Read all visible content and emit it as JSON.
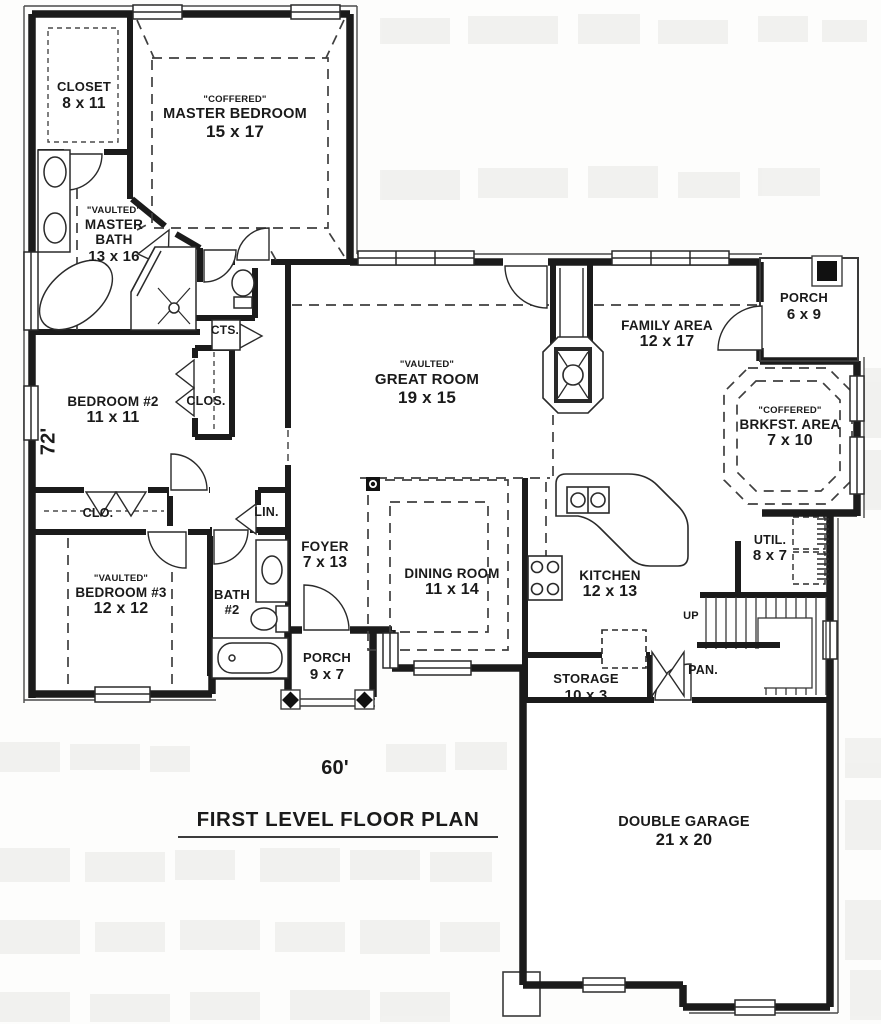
{
  "plan": {
    "title": "FIRST LEVEL FLOOR PLAN",
    "overall_width": "60'",
    "overall_depth": "72'",
    "rooms": {
      "closet": {
        "name": "CLOSET",
        "dims": "8 x 11"
      },
      "master_bedroom": {
        "ceiling": "\"COFFERED\"",
        "name": "MASTER BEDROOM",
        "dims": "15 x 17"
      },
      "master_bath": {
        "ceiling": "\"VAULTED\"",
        "name": "MASTER BATH",
        "dims": "13 x 16"
      },
      "cts": {
        "name": "CTS."
      },
      "bedroom2": {
        "name": "BEDROOM #2",
        "dims": "11 x 11"
      },
      "clos": {
        "name": "CLOS."
      },
      "great_room": {
        "ceiling": "\"VAULTED\"",
        "name": "GREAT ROOM",
        "dims": "19 x 15"
      },
      "family_area": {
        "name": "FAMILY AREA",
        "dims": "12 x 17"
      },
      "porch_rear": {
        "name": "PORCH",
        "dims": "6 x 9"
      },
      "brkfst": {
        "ceiling": "\"COFFERED\"",
        "name": "BRKFST. AREA",
        "dims": "7 x 10"
      },
      "clo": {
        "name": "CLO."
      },
      "lin": {
        "name": "LIN."
      },
      "foyer": {
        "name": "FOYER",
        "dims": "7 x 13"
      },
      "bedroom3": {
        "ceiling": "\"VAULTED\"",
        "name": "BEDROOM #3",
        "dims": "12 x 12"
      },
      "bath2": {
        "name": "BATH",
        "num": "#2"
      },
      "porch_front": {
        "name": "PORCH",
        "dims": "9 x 7"
      },
      "dining": {
        "name": "DINING ROOM",
        "dims": "11 x 14"
      },
      "kitchen": {
        "name": "KITCHEN",
        "dims": "12 x 13"
      },
      "storage": {
        "name": "STORAGE",
        "dims": "10 x 3"
      },
      "util": {
        "name": "UTIL.",
        "dims": "8 x 7"
      },
      "stairs": {
        "name": "UP"
      },
      "pan": {
        "name": "PAN."
      },
      "garage": {
        "name": "DOUBLE GARAGE",
        "dims": "21 x 20"
      }
    },
    "colors": {
      "wall": "#1b1b1b",
      "thin_line": "#3a3a3a",
      "background": "#fdfdfc",
      "noise": "#e9e9e5",
      "text": "#1a1a1a"
    }
  }
}
